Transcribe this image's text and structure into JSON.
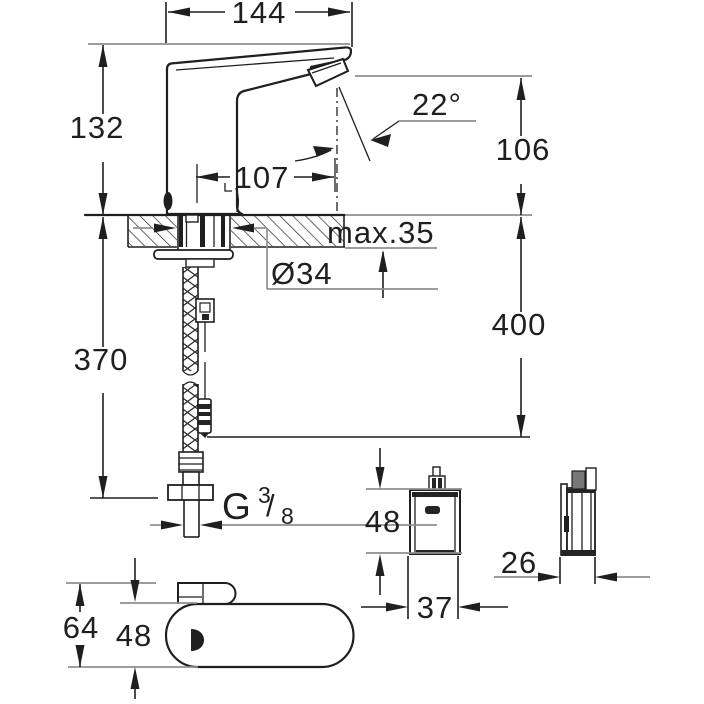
{
  "drawing": {
    "labels": {
      "total_length": "144",
      "body_height": "132",
      "spout_reach": "107",
      "spray_angle": "22°",
      "outlet_height": "106",
      "max_deck": "max.35",
      "hole_diameter": "Ø34",
      "cable_drop": "400",
      "hose_length": "370",
      "thread_letter": "G",
      "thread_numerator": "3",
      "thread_slash": "/",
      "thread_denominator": "8",
      "box_height": "48",
      "box_width": "37",
      "box_depth": "26",
      "base_total_height": "64",
      "base_body_height": "48"
    },
    "colors": {
      "line": "#1f1f1f",
      "reference": "#8f8f8f",
      "background": "#ffffff"
    }
  }
}
